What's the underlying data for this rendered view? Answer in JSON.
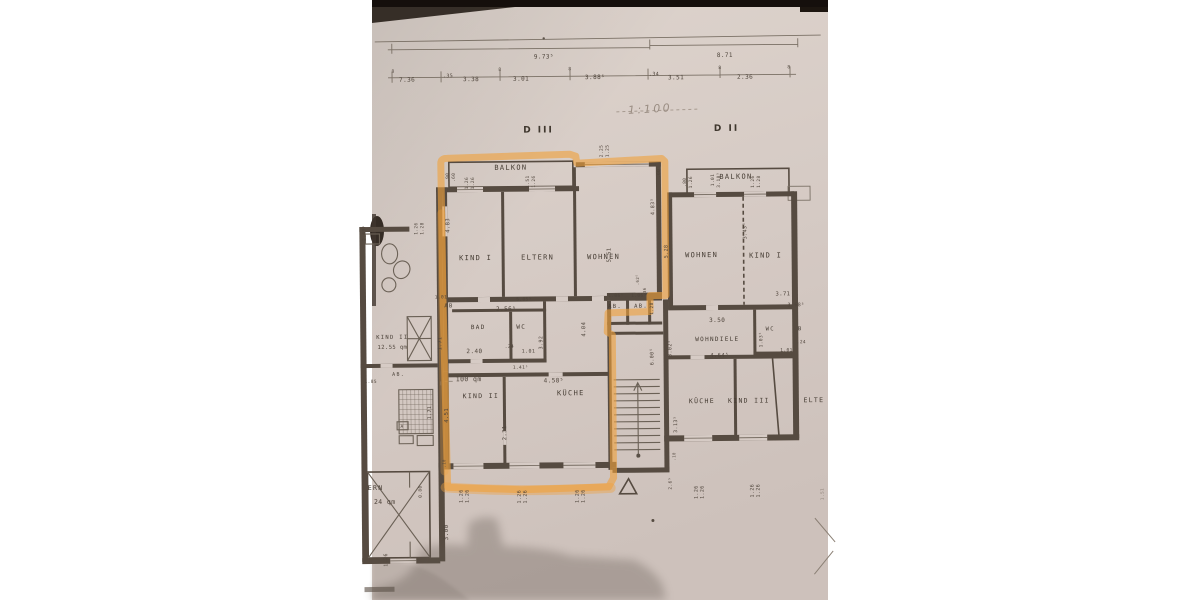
{
  "photo": {
    "description_of_content": "photograph of an architectural floor plan copy",
    "paper_color": "#d6cbc5",
    "line_color": "#564b41",
    "highlight_color": "#efa13d",
    "shadow_color": "#5f554e",
    "scale_note": "1:100",
    "sections": [
      {
        "label": "D III"
      },
      {
        "label": "D II"
      }
    ],
    "highlighted_unit": "D III right apartment outlined in orange marker"
  },
  "dimension_chain": {
    "totals": [
      "9.73⁵",
      "8.71"
    ],
    "segments": [
      "7.36",
      ".35",
      "3.38",
      "3.01",
      "3.88⁵",
      ".34",
      "3.51",
      "2.36"
    ]
  },
  "rooms_d3": [
    "BALKON",
    "KIND I",
    "ELTERN",
    "WOHNEN",
    "BAD",
    "WC",
    "AB",
    "AB.",
    "AB.",
    "KIND II",
    "KÜCHE"
  ],
  "rooms_d2": [
    "BALKON",
    "WOHNEN",
    "KIND I",
    "WC",
    "WOHNDIELE",
    "KÜCHE",
    "KIND III",
    "ELTE"
  ],
  "rooms_left": [
    "KIND II",
    "12.55 qm",
    "AB.",
    "A",
    "ERN",
    "24 qm"
  ],
  "area_note": "100 qm",
  "labels": [
    {
      "t": "9.73⁵",
      "x": 546,
      "y": 58,
      "s": 6,
      "n": "dim-total-left"
    },
    {
      "t": "8.71",
      "x": 727,
      "y": 58,
      "s": 6,
      "n": "dim-total-right"
    },
    {
      "t": "7.36",
      "x": 409,
      "y": 80,
      "s": 6
    },
    {
      "t": ".35",
      "x": 450,
      "y": 76,
      "s": 5
    },
    {
      "t": "3.38",
      "x": 473,
      "y": 80,
      "s": 6
    },
    {
      "t": "3.01",
      "x": 523,
      "y": 80,
      "s": 6
    },
    {
      "t": "3.88⁵",
      "x": 597,
      "y": 79,
      "s": 6
    },
    {
      "t": ".34",
      "x": 656,
      "y": 76,
      "s": 5
    },
    {
      "t": "3.51",
      "x": 678,
      "y": 80,
      "s": 6
    },
    {
      "t": "2.36",
      "x": 747,
      "y": 80,
      "s": 6
    },
    {
      "t": "8",
      "x": 395,
      "y": 71,
      "s": 4.5
    },
    {
      "t": "8",
      "x": 502,
      "y": 70,
      "s": 4.5
    },
    {
      "t": "8",
      "x": 572,
      "y": 70,
      "s": 4.5
    },
    {
      "t": "8",
      "x": 722,
      "y": 70,
      "s": 4.5
    },
    {
      "t": "8",
      "x": 791,
      "y": 70,
      "s": 4.5
    },
    {
      "t": "1:100",
      "x": 652,
      "y": 113,
      "s": 11,
      "r": -3,
      "c": "hand",
      "n": "scale-note"
    },
    {
      "t": "D III",
      "x": 540,
      "y": 132,
      "s": 9,
      "c": "section",
      "n": "section-label-d3"
    },
    {
      "t": "D II",
      "x": 728,
      "y": 132,
      "s": 9,
      "c": "section",
      "n": "section-label-d2"
    },
    {
      "t": "BALKON",
      "x": 512,
      "y": 169,
      "s": 7,
      "c": "room",
      "n": "room-label-balkon-d3"
    },
    {
      "t": "KIND I",
      "x": 476,
      "y": 259,
      "s": 7,
      "c": "room",
      "n": "room-label-kind1-d3"
    },
    {
      "t": "ELTERN",
      "x": 538,
      "y": 259,
      "s": 7,
      "c": "room",
      "n": "room-label-eltern-d3"
    },
    {
      "t": "WOHNEN",
      "x": 604,
      "y": 259,
      "s": 7,
      "c": "room",
      "n": "room-label-wohnen-d3"
    },
    {
      "t": ".90",
      "x": 450,
      "y": 176,
      "s": 4.5,
      "r": -90
    },
    {
      "t": ".60",
      "x": 456,
      "y": 176,
      "s": 4.5,
      "r": -90
    },
    {
      "t": "1.26",
      "x": 469,
      "y": 182,
      "s": 4.5,
      "r": -90
    },
    {
      "t": "1.26",
      "x": 475,
      "y": 182,
      "s": 4.5,
      "r": -90
    },
    {
      "t": "1.51",
      "x": 530,
      "y": 181,
      "s": 4.5,
      "r": -90
    },
    {
      "t": "1.26",
      "x": 536,
      "y": 181,
      "s": 4.5,
      "r": -90
    },
    {
      "t": "2.25",
      "x": 604,
      "y": 151,
      "s": 4.5,
      "r": -90
    },
    {
      "t": "1.25",
      "x": 610,
      "y": 151,
      "s": 4.5,
      "r": -90
    },
    {
      "t": ".60",
      "x": 661,
      "y": 174,
      "s": 4.5,
      "r": -90
    },
    {
      "t": "4.83",
      "x": 450,
      "y": 224,
      "s": 5.5,
      "r": -90
    },
    {
      "t": "5.51",
      "x": 611,
      "y": 255,
      "s": 5.5,
      "r": -90
    },
    {
      "t": "4.83⁵",
      "x": 655,
      "y": 207,
      "s": 5,
      "r": -90
    },
    {
      "t": "5.28",
      "x": 668,
      "y": 252,
      "s": 5,
      "r": -90
    },
    {
      "t": ".62⁵",
      "x": 639,
      "y": 280,
      "s": 4,
      "r": -90
    },
    {
      "t": ".36",
      "x": 646,
      "y": 292,
      "s": 4,
      "r": -90
    },
    {
      "t": "1.01",
      "x": 441,
      "y": 297,
      "s": 4.5
    },
    {
      "t": "AB",
      "x": 449,
      "y": 306,
      "s": 5.5,
      "c": "room",
      "n": "room-label-ab-d3"
    },
    {
      "t": "2.56⁵",
      "x": 506,
      "y": 310,
      "s": 6
    },
    {
      "t": "5.05⁵",
      "x": 524,
      "y": 300,
      "s": 4.5
    },
    {
      "t": "BAD",
      "x": 478,
      "y": 328,
      "s": 6,
      "c": "room",
      "n": "room-label-bad-d3"
    },
    {
      "t": "WC",
      "x": 521,
      "y": 328,
      "s": 6,
      "c": "room",
      "n": "room-label-wc-d3"
    },
    {
      "t": "1.71",
      "x": 441,
      "y": 342,
      "s": 5,
      "r": -90
    },
    {
      "t": "2.40",
      "x": 474,
      "y": 352,
      "s": 6
    },
    {
      "t": ".24",
      "x": 509,
      "y": 347,
      "s": 4.5
    },
    {
      "t": "1.01",
      "x": 528,
      "y": 352,
      "s": 5
    },
    {
      "t": "3.92",
      "x": 542,
      "y": 342,
      "s": 5,
      "r": -90
    },
    {
      "t": "4.04",
      "x": 585,
      "y": 329,
      "s": 5.5,
      "r": -90
    },
    {
      "t": "1.41⁵",
      "x": 520,
      "y": 368,
      "s": 4.5
    },
    {
      "t": "1.06⁵",
      "x": 616,
      "y": 297,
      "s": 4.5
    },
    {
      "t": "1.06⁵",
      "x": 639,
      "y": 297,
      "s": 4.5
    },
    {
      "t": "AB.",
      "x": 615,
      "y": 308,
      "s": 5.5,
      "c": "room",
      "n": "room-label-ab1-stair"
    },
    {
      "t": "AB.",
      "x": 641,
      "y": 308,
      "s": 5.5,
      "c": "room",
      "n": "room-label-ab2-stair"
    },
    {
      "t": "1.28",
      "x": 653,
      "y": 309,
      "s": 4.5,
      "r": -90
    },
    {
      "t": "100 qm",
      "x": 468,
      "y": 380,
      "s": 6.5,
      "n": "area-label-100qm"
    },
    {
      "t": "KIND II",
      "x": 480,
      "y": 397,
      "s": 6.5,
      "c": "room",
      "n": "room-label-kind2-d3"
    },
    {
      "t": "KÜCHE",
      "x": 570,
      "y": 395,
      "s": 7,
      "c": "room",
      "n": "room-label-kueche-d3"
    },
    {
      "t": "4.58⁵",
      "x": 553,
      "y": 382,
      "s": 6
    },
    {
      "t": "2.31",
      "x": 505,
      "y": 432,
      "s": 5.5,
      "r": -90
    },
    {
      "t": "4.51",
      "x": 447,
      "y": 414,
      "s": 5.5,
      "r": -90
    },
    {
      "t": ".10",
      "x": 444,
      "y": 462,
      "s": 4,
      "r": -90
    },
    {
      "t": "0.80",
      "x": 420,
      "y": 490,
      "s": 4.5,
      "r": -90
    },
    {
      "t": "3.00",
      "x": 446,
      "y": 531,
      "s": 6,
      "r": -90
    },
    {
      "t": "1.26",
      "x": 461,
      "y": 495,
      "s": 5,
      "r": -90
    },
    {
      "t": "1.26",
      "x": 467,
      "y": 495,
      "s": 5,
      "r": -90
    },
    {
      "t": "1.26",
      "x": 519,
      "y": 496,
      "s": 5,
      "r": -90
    },
    {
      "t": "1.26",
      "x": 525,
      "y": 496,
      "s": 5,
      "r": -90
    },
    {
      "t": "1.26",
      "x": 577,
      "y": 496,
      "s": 5,
      "r": -90
    },
    {
      "t": "1.26",
      "x": 583,
      "y": 496,
      "s": 5,
      "r": -90
    },
    {
      "t": "6.00⁵",
      "x": 653,
      "y": 357,
      "s": 5,
      "r": -90
    },
    {
      "t": "3.02⁵",
      "x": 671,
      "y": 349,
      "s": 5,
      "r": -90
    },
    {
      "t": "3.50",
      "x": 717,
      "y": 323,
      "s": 6
    },
    {
      "t": "3.13⁵",
      "x": 676,
      "y": 425,
      "s": 5,
      "r": -90
    },
    {
      "t": "1.03⁵",
      "x": 762,
      "y": 341,
      "s": 4.5,
      "r": -90
    },
    {
      "t": "BALKON",
      "x": 737,
      "y": 180,
      "s": 7,
      "c": "room",
      "n": "room-label-balkon-d2"
    },
    {
      "t": ".80",
      "x": 687,
      "y": 183,
      "s": 4.5,
      "r": -90
    },
    {
      "t": "1.26",
      "x": 693,
      "y": 183,
      "s": 4.5,
      "r": -90
    },
    {
      "t": "1.01",
      "x": 715,
      "y": 181,
      "s": 4.5,
      "r": -90
    },
    {
      "t": "3.18⁵",
      "x": 721,
      "y": 181,
      "s": 4.5,
      "r": -90
    },
    {
      "t": "1.26",
      "x": 755,
      "y": 183,
      "s": 4.5,
      "r": -90
    },
    {
      "t": "1.28",
      "x": 761,
      "y": 183,
      "s": 4.5,
      "r": -90
    },
    {
      "t": "WOHNEN",
      "x": 702,
      "y": 258,
      "s": 7,
      "c": "room",
      "n": "room-label-wohnen-d2"
    },
    {
      "t": "KIND I",
      "x": 766,
      "y": 259,
      "s": 7,
      "c": "room",
      "n": "room-label-kind1-d2"
    },
    {
      "t": "3.43⁵",
      "x": 747,
      "y": 232,
      "s": 5,
      "r": -90
    },
    {
      "t": "3.71",
      "x": 783,
      "y": 297,
      "s": 5.5
    },
    {
      "t": "3.68⁵",
      "x": 796,
      "y": 308,
      "s": 5
    },
    {
      "t": "WC",
      "x": 770,
      "y": 332,
      "s": 5.5,
      "c": "room",
      "n": "room-label-wc-d2"
    },
    {
      "t": "B",
      "x": 800,
      "y": 332,
      "s": 5.5,
      "c": "room"
    },
    {
      "t": ".24",
      "x": 801,
      "y": 345,
      "s": 4.5
    },
    {
      "t": "1.01",
      "x": 786,
      "y": 353,
      "s": 4.5
    },
    {
      "t": "WOHNDIELE",
      "x": 717,
      "y": 342,
      "s": 6,
      "c": "room",
      "n": "room-label-wohndiele-d2"
    },
    {
      "t": "4.64⁵",
      "x": 719,
      "y": 358,
      "s": 5.5
    },
    {
      "t": "KÜCHE",
      "x": 701,
      "y": 404,
      "s": 6.5,
      "c": "room",
      "n": "room-label-kueche-d2"
    },
    {
      "t": "KIND III",
      "x": 748,
      "y": 404,
      "s": 6.5,
      "c": "room",
      "n": "room-label-kind3-d2"
    },
    {
      "t": "ELTE",
      "x": 813,
      "y": 404,
      "s": 6.5,
      "c": "room",
      "n": "room-label-elte-d2"
    },
    {
      "t": "2.6⁵",
      "x": 670,
      "y": 484,
      "s": 4.5,
      "r": -90
    },
    {
      "t": ".10",
      "x": 674,
      "y": 457,
      "s": 4,
      "r": -90
    },
    {
      "t": "1.26",
      "x": 696,
      "y": 493,
      "s": 5,
      "r": -90
    },
    {
      "t": "1.26",
      "x": 702,
      "y": 493,
      "s": 5,
      "r": -90
    },
    {
      "t": "1.26",
      "x": 752,
      "y": 492,
      "s": 5,
      "r": -90
    },
    {
      "t": "1.26",
      "x": 758,
      "y": 492,
      "s": 5,
      "r": -90
    },
    {
      "t": "1.51",
      "x": 822,
      "y": 496,
      "s": 4.5,
      "r": -90,
      "c": "faint"
    },
    {
      "t": "2.69⁵",
      "x": 366,
      "y": 231,
      "s": 4.5,
      "r": -90
    },
    {
      "t": "1.26",
      "x": 418,
      "y": 227,
      "s": 4.5,
      "r": -90
    },
    {
      "t": "1.28",
      "x": 424,
      "y": 227,
      "s": 4.5,
      "r": -90
    },
    {
      "t": "KIND II",
      "x": 392,
      "y": 337,
      "s": 5.5,
      "c": "room",
      "n": "room-label-kind2-left"
    },
    {
      "t": "12.55 qm",
      "x": 392,
      "y": 347,
      "s": 5.5,
      "n": "area-label-1255qm"
    },
    {
      "t": "AB.",
      "x": 398,
      "y": 374,
      "s": 5,
      "c": "room"
    },
    {
      "t": "1.85",
      "x": 370,
      "y": 381,
      "s": 4.5
    },
    {
      "t": "A",
      "x": 401,
      "y": 426,
      "s": 4.5
    },
    {
      "t": "1.71",
      "x": 430,
      "y": 411,
      "s": 5,
      "r": -90
    },
    {
      "t": "ERN",
      "x": 374,
      "y": 488,
      "s": 6.5,
      "c": "room",
      "n": "room-label-ern-left"
    },
    {
      "t": "24 qm",
      "x": 383,
      "y": 502,
      "s": 6.5,
      "n": "area-label-24qm"
    },
    {
      "t": "1.26",
      "x": 385,
      "y": 558,
      "s": 5,
      "r": -90
    }
  ]
}
